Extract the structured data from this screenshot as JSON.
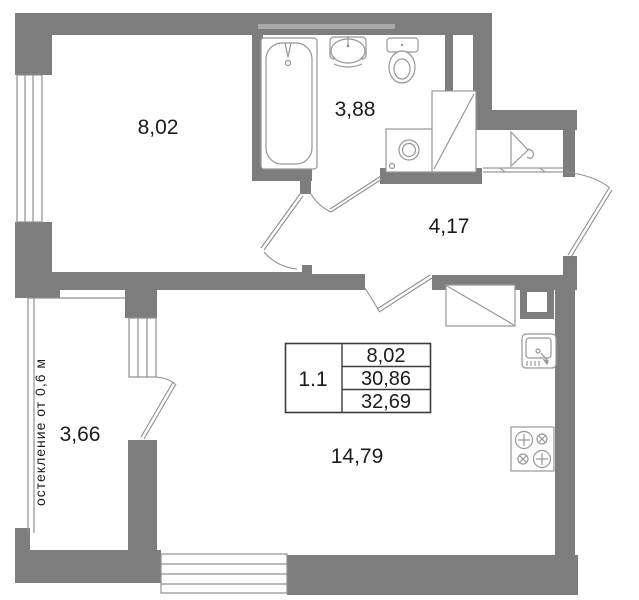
{
  "plan": {
    "rooms": [
      {
        "id": "room-top",
        "area_label": "8,02"
      },
      {
        "id": "bathroom",
        "area_label": "3,88"
      },
      {
        "id": "hallway",
        "area_label": "4,17"
      },
      {
        "id": "balcony",
        "area_label": "3,66"
      },
      {
        "id": "living",
        "area_label": "14,79"
      }
    ],
    "balcony_note": "остекление от 0,6 м",
    "info_table": {
      "unit_label": "1.1",
      "rows": [
        "8,02",
        "30,86",
        "32,69"
      ]
    },
    "fixtures": [
      "bathtub",
      "wash-basin",
      "toilet",
      "washing-machine",
      "wardrobe",
      "hanger-closet",
      "hall-closet",
      "vent-shaft",
      "kitchen-sink",
      "stove"
    ],
    "colors": {
      "wall": "#7d7d7d",
      "beam": "#a9a9a9",
      "fixture_stroke": "#979797",
      "door_stroke": "#8f8f8f",
      "table_border": "#3c3c3c",
      "text": "#1b1b1b"
    }
  }
}
